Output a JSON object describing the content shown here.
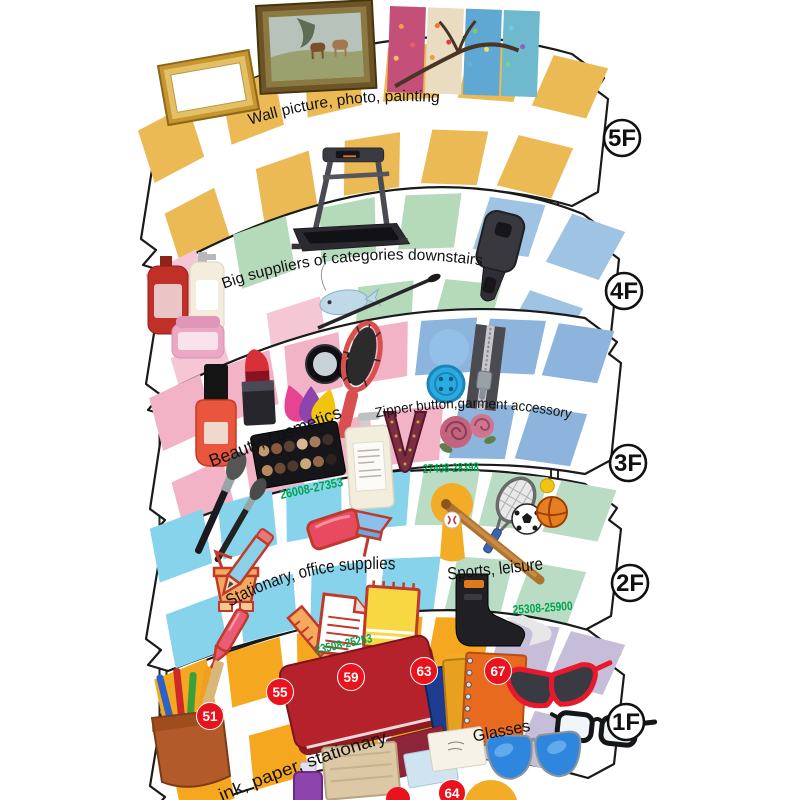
{
  "palette": {
    "outline": "#1a1a1a",
    "tile_gold_5f": "#EBBA55",
    "tile_gold_1f": "#F5A81F",
    "tile_pink_4f": "#F5C6D3",
    "tile_green_4f": "#B5DABA",
    "tile_blue_4f": "#9FC3E2",
    "tile_pink_3f": "#F3B3C7",
    "tile_blue_3f": "#8CB4DC",
    "tile_cyan_2f": "#87D3EC",
    "tile_green_2f": "#BADCC4",
    "tile_lavender_1f": "#C6BDD9",
    "badge_red": "#E8131D",
    "range_green": "#00A44F",
    "paddle_gold": "#F2AC25",
    "paddle_blue": "#92C0E8"
  },
  "floors": [
    {
      "label": "5F",
      "categories": [
        {
          "name": "Wall picture, photo, painting"
        }
      ],
      "illustrations": [
        "empty-gold-picture-frame",
        "framed-horse-painting",
        "four-season-tree-canvas"
      ]
    },
    {
      "label": "4F",
      "categories": [
        {
          "name": "Big suppliers of categories downstairs"
        }
      ],
      "illustrations": [
        "treadmill",
        "bath-lotion-bottles",
        "fish-charm",
        "mascara-wand",
        "zipper-slider"
      ]
    },
    {
      "label": "3F",
      "categories": [
        {
          "name": "Beauty, cosmetics",
          "range": "26008-27353"
        },
        {
          "name": "Zipper,button,garment accessory",
          "range": "27408-28398"
        }
      ],
      "illustrations": [
        "nail-polish",
        "lipstick",
        "beauty-sponges",
        "compact-mirror",
        "hair-brush",
        "eyeshadow-palette",
        "lotion-pump-bottle",
        "makeup-brushes",
        "blue-button",
        "zipper",
        "lace-collar",
        "embroidered-roses"
      ]
    },
    {
      "label": "2F",
      "categories": [
        {
          "name": "Stationary, office supplies",
          "range": "23508-25253"
        },
        {
          "name": "Sports, leisure",
          "range": "25308-25900"
        }
      ],
      "illustrations": [
        "binder-clip",
        "pencil",
        "eraser",
        "push-pin",
        "pen",
        "ruler",
        "document",
        "notepad",
        "tennis-racket",
        "baseball-bat",
        "baseball",
        "soccer-ball",
        "basketball",
        "ankle-brace"
      ]
    },
    {
      "label": "1F",
      "categories": [
        {
          "name": "ink, paper, stationary"
        },
        {
          "name": "Glasses"
        }
      ],
      "booth_badges": [
        "51",
        "55",
        "59",
        "63",
        "67",
        "64"
      ],
      "illustrations": [
        "pen-holder-cup",
        "red-notebook",
        "spiral-notebooks",
        "greeting-cards",
        "ink-bottle",
        "wooden-board",
        "red-cat-eye-sunglasses",
        "black-eyeglasses",
        "blue-aviator-sunglasses"
      ]
    }
  ]
}
